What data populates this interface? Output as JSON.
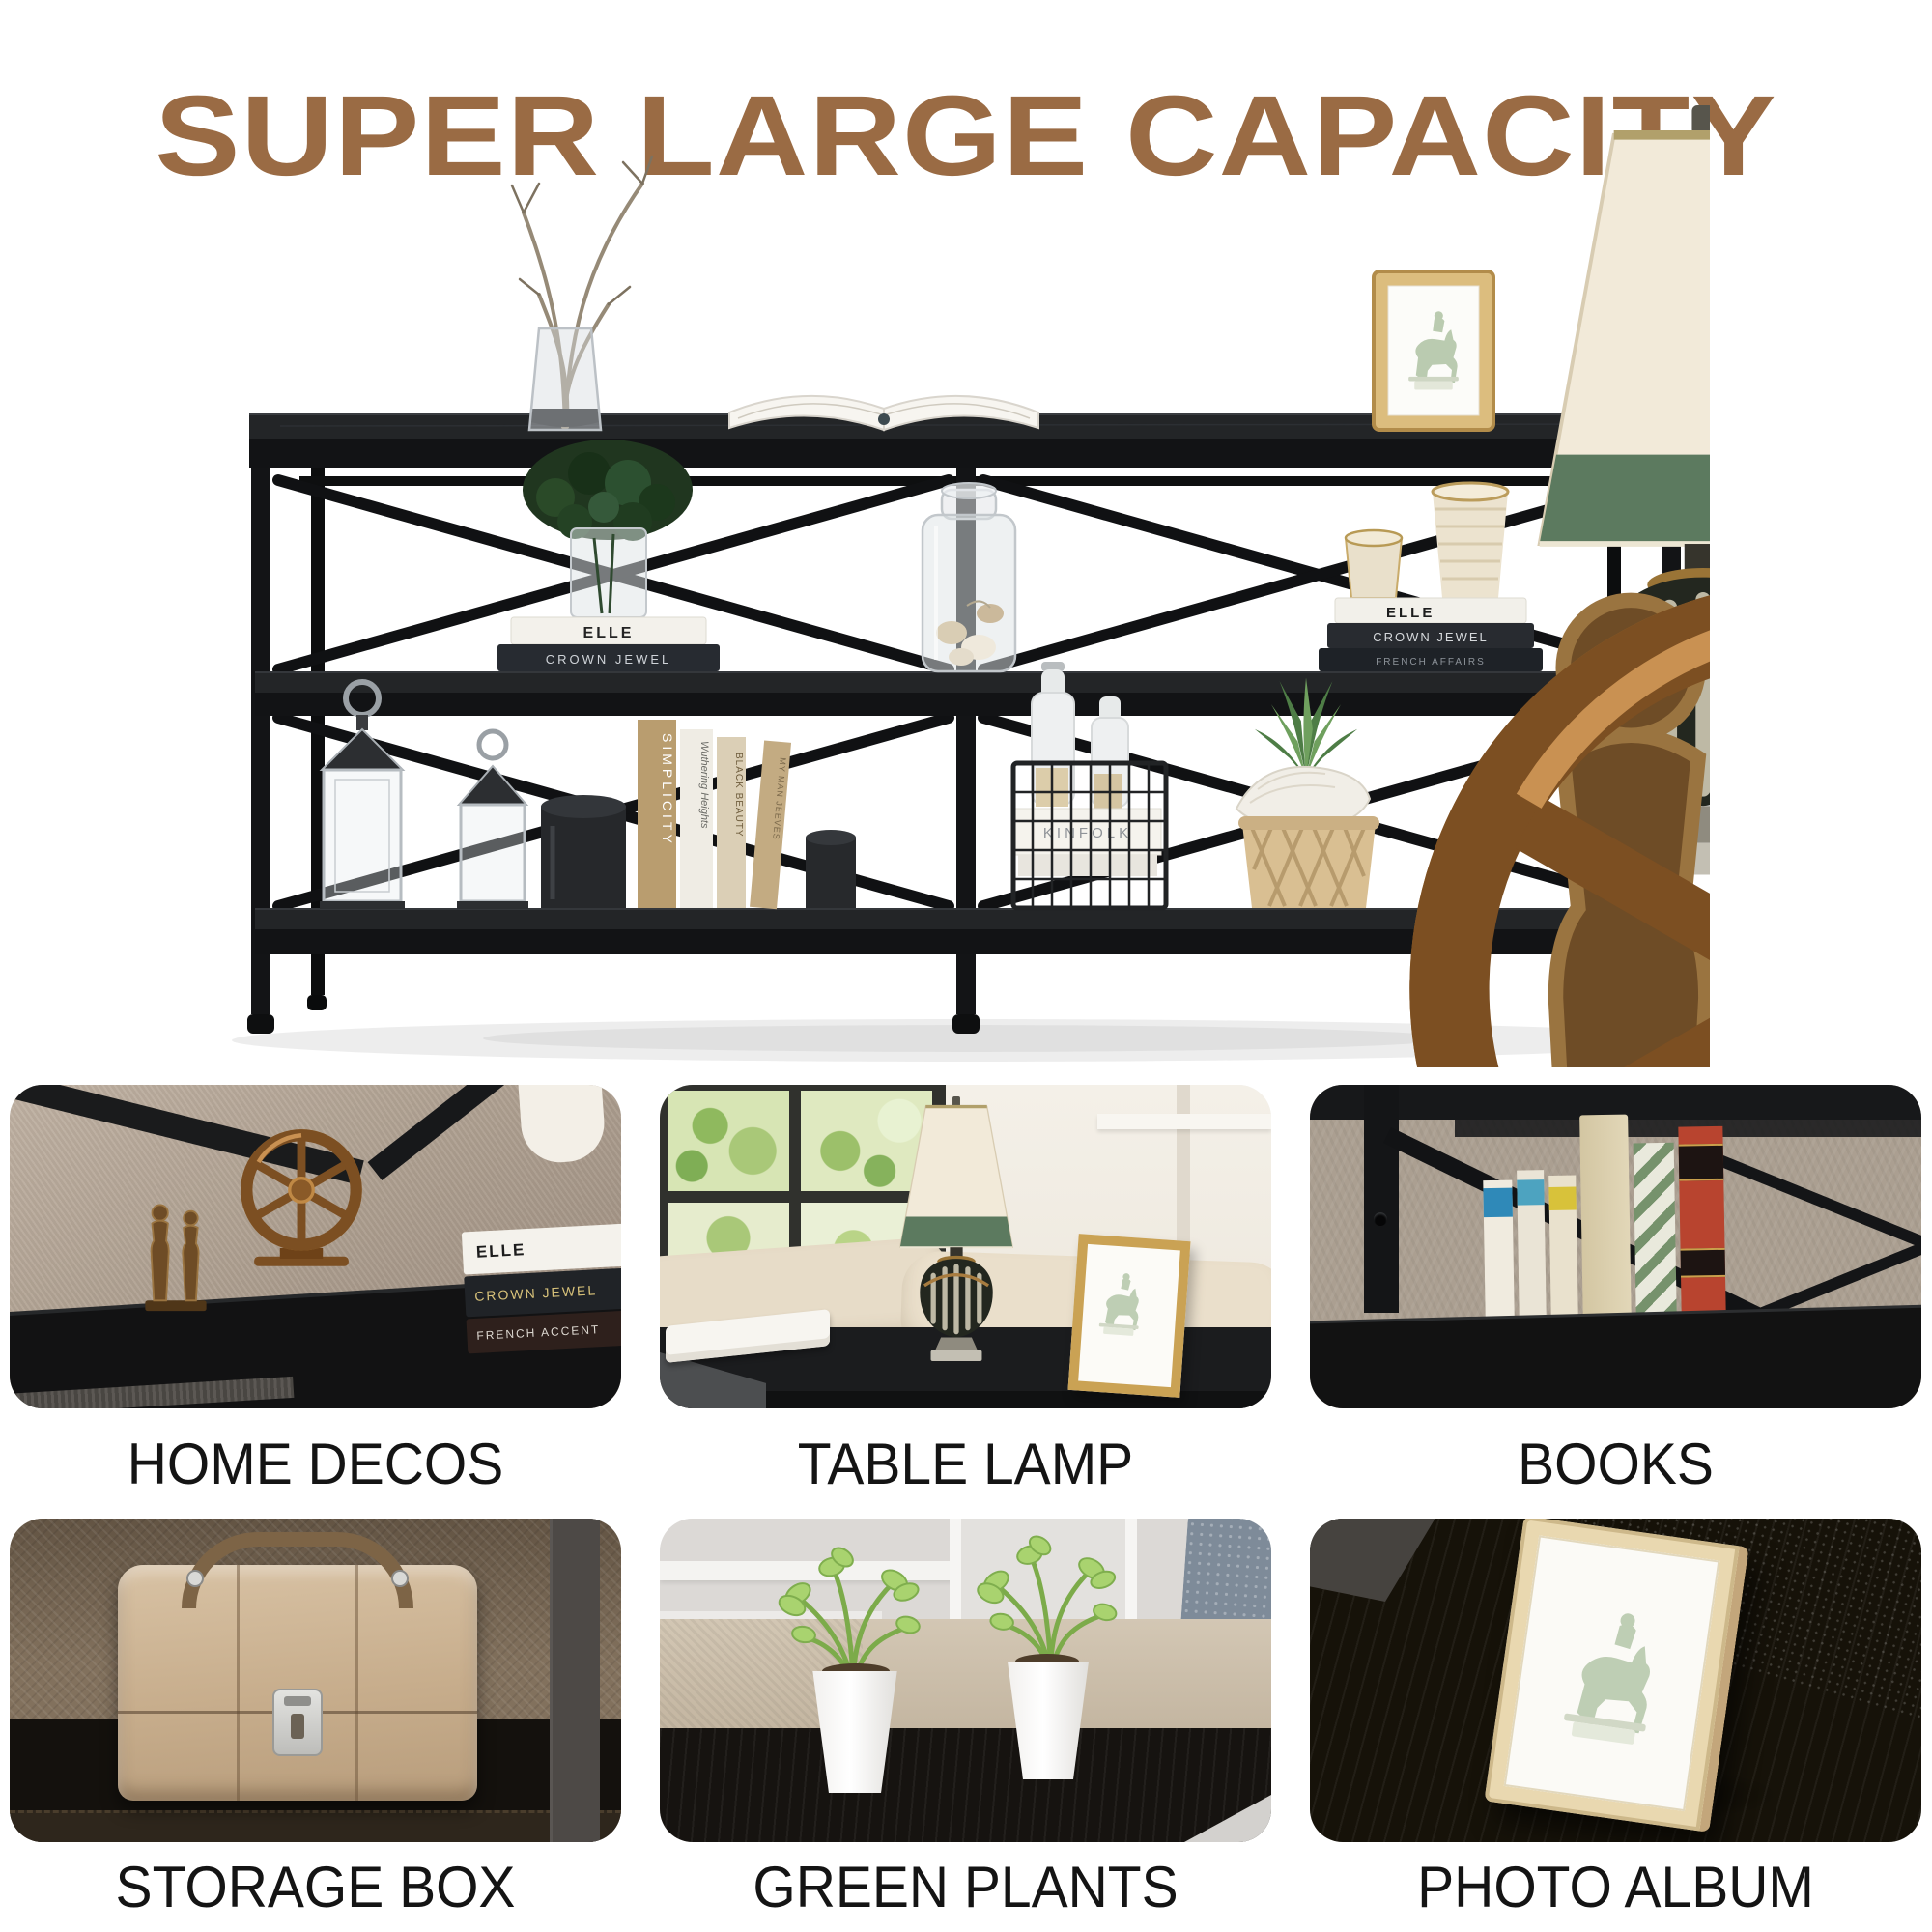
{
  "title": "SUPER LARGE CAPACITY",
  "hero": {
    "books": {
      "mid_left": [
        "ELLE",
        "CROWN JEWEL"
      ],
      "mid_right": [
        "ELLE",
        "CROWN JEWEL",
        "FRENCH AFFAIRS"
      ],
      "standing": [
        "SIMPLICITY",
        "Wuthering Heights",
        "BLACK BEAUTY",
        "MY MAN JEEVES"
      ],
      "basket": "KINFOLK"
    }
  },
  "grid": {
    "cells": [
      {
        "caption": "HOME DECOS",
        "books": [
          "ELLE",
          "CROWN JEWEL",
          "FRENCH ACCENT"
        ]
      },
      {
        "caption": "TABLE LAMP"
      },
      {
        "caption": "BOOKS"
      },
      {
        "caption": "STORAGE BOX"
      },
      {
        "caption": "GREEN PLANTS"
      },
      {
        "caption": "PHOTO ALBUM"
      }
    ]
  },
  "colors": {
    "title_brown": "#9a6b44",
    "caption_black": "#141414",
    "table_black": "#17181a",
    "lamp_shade_cream": "#f2ead9",
    "lamp_band_green": "#5c7a5f",
    "frame_gold": "#d9b977",
    "bronze": "#8a5a28",
    "case_tan": "#c9b296",
    "plant_green": "#a9d36f",
    "background": "#ffffff"
  }
}
